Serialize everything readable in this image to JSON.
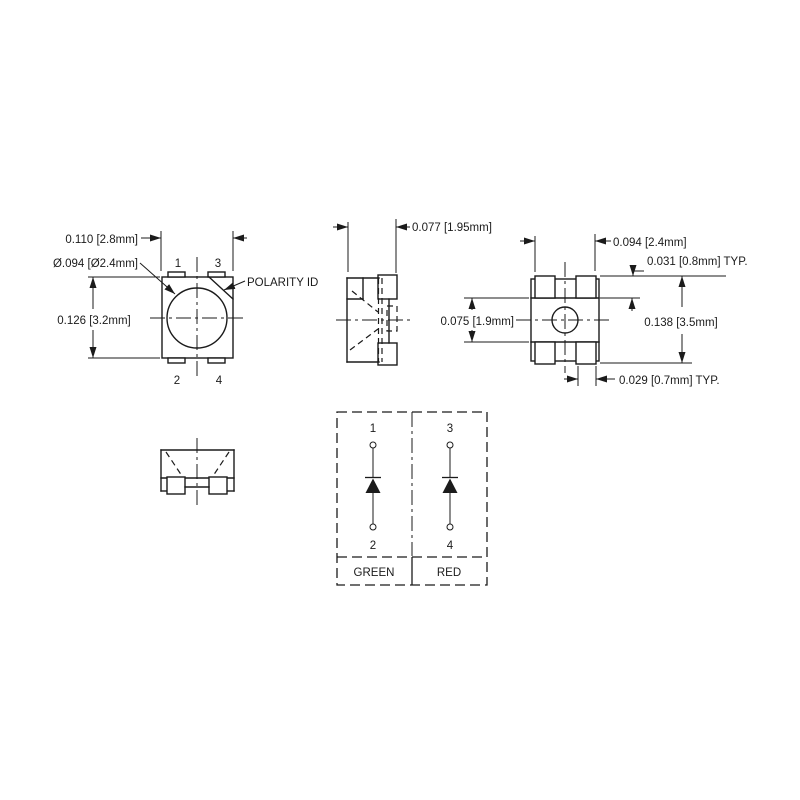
{
  "drawing": {
    "title_hint": "SMD LED package mechanical drawing",
    "colors": {
      "line": "#1b1b1b",
      "background": "#ffffff"
    },
    "top_view": {
      "dim_width": "0.110 [2.8mm]",
      "dim_lens_diameter": "Ø.094 [Ø2.4mm]",
      "dim_height": "0.126 [3.2mm]",
      "polarity_label": "POLARITY ID",
      "pin1": "1",
      "pin2": "2",
      "pin3": "3",
      "pin4": "4"
    },
    "side_view": {
      "dim_depth": "0.077 [1.95mm]"
    },
    "bottom_view": {
      "dim_pad_span": "0.094 [2.4mm]",
      "dim_pad_height": "0.031 [0.8mm] TYP.",
      "dim_body_gap": "0.075 [1.9mm]",
      "dim_overall_height": "0.138 [3.5mm]",
      "dim_pad_width": "0.029 [0.7mm] TYP."
    },
    "schematic": {
      "pin1": "1",
      "pin2": "2",
      "pin3": "3",
      "pin4": "4",
      "left_channel": "GREEN",
      "right_channel": "RED"
    }
  }
}
